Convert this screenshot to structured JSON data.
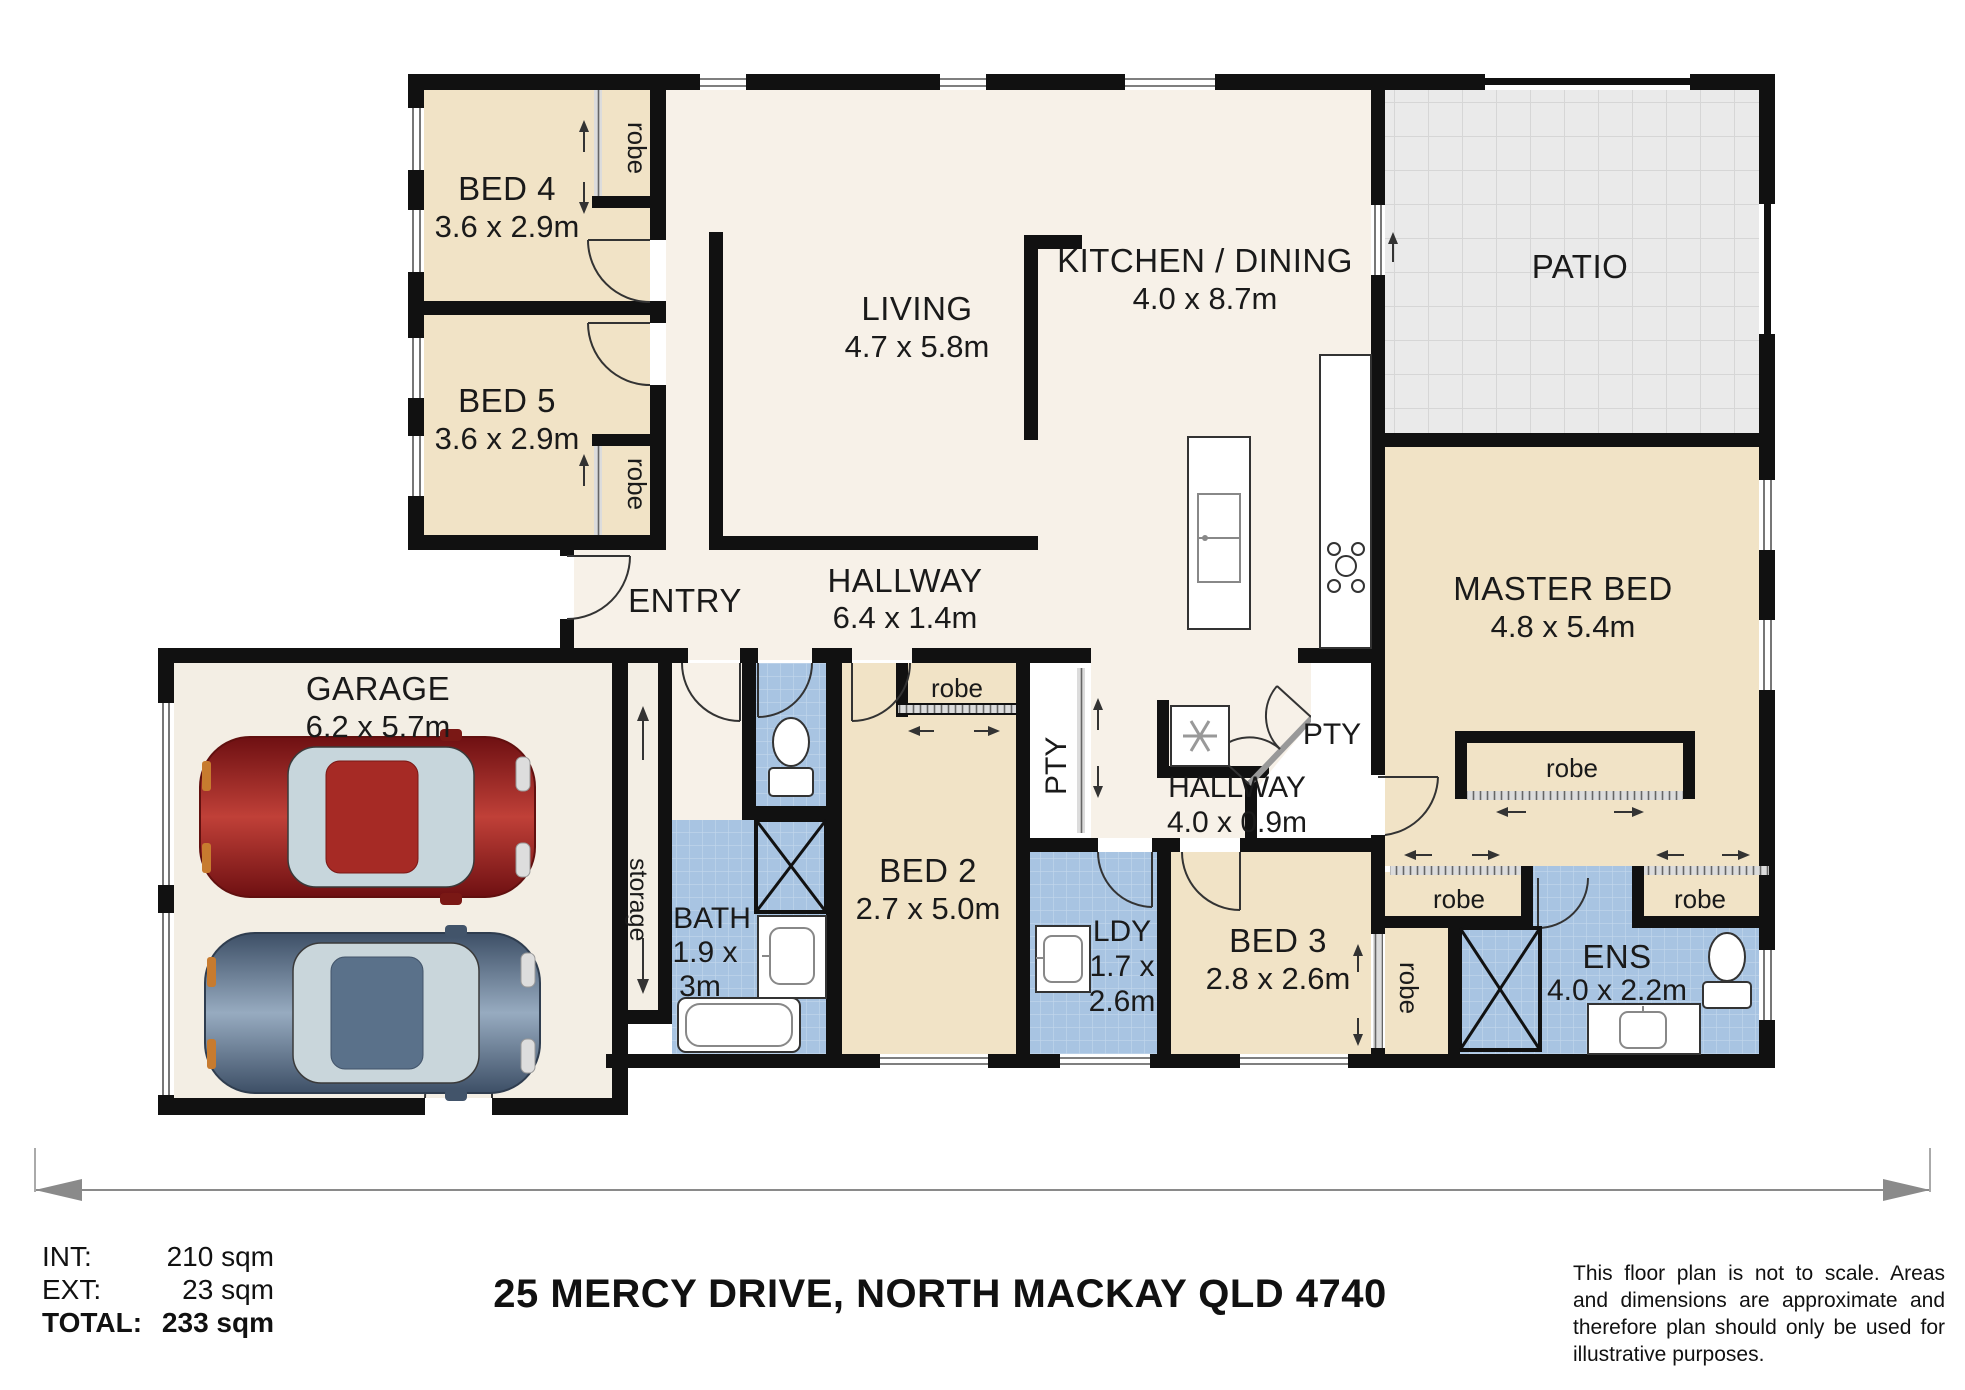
{
  "title": "25 MERCY DRIVE, NORTH MACKAY QLD 4740",
  "areas": {
    "int_label": "INT:",
    "int_value": "210 sqm",
    "ext_label": "EXT:",
    "ext_value": "23 sqm",
    "total_label": "TOTAL:",
    "total_value": "233 sqm"
  },
  "disclaimer": "This floor plan is not to scale. Areas and dimensions are approximate and therefore plan should only be used for illustrative purposes.",
  "rooms": {
    "bed4": {
      "name": "BED 4",
      "dims": "3.6 x 2.9m"
    },
    "bed5": {
      "name": "BED 5",
      "dims": "3.6 x 2.9m"
    },
    "living": {
      "name": "LIVING",
      "dims": "4.7 x 5.8m"
    },
    "kitchen_dining": {
      "name": "KITCHEN / DINING",
      "dims": "4.0 x 8.7m"
    },
    "patio": {
      "name": "PATIO"
    },
    "master_bed": {
      "name": "MASTER BED",
      "dims": "4.8 x 5.4m"
    },
    "entry": {
      "name": "ENTRY"
    },
    "hallway_main": {
      "name": "HALLWAY",
      "dims": "6.4 x 1.4m"
    },
    "hallway_rear": {
      "name": "HALLWAY",
      "dims": "4.0 x 0.9m"
    },
    "garage": {
      "name": "GARAGE",
      "dims": "6.2 x 5.7m"
    },
    "bed2": {
      "name": "BED 2",
      "dims": "2.7 x 5.0m"
    },
    "bed3": {
      "name": "BED 3",
      "dims": "2.8 x 2.6m"
    },
    "bath": {
      "name": "BATH",
      "dims1": "1.9 x",
      "dims2": "3m"
    },
    "laundry": {
      "name": "LDY",
      "dims1": "1.7 x",
      "dims2": "2.6m"
    },
    "ensuite": {
      "name": "ENS",
      "dims": "4.0 x 2.2m"
    },
    "storage": {
      "name": "storage"
    }
  },
  "labels": {
    "robe": "robe",
    "pantry": "PTY"
  },
  "icons": {
    "fridge": "snowflake",
    "cooktop": "burner-rings",
    "shower": "x-cross",
    "toilet": "toilet",
    "sink": "basin",
    "bathtub": "tub",
    "laundry_tub": "square-tub",
    "cars": "car-top-view"
  },
  "colors": {
    "wall": "#111111",
    "bedroom": "#f1e3c6",
    "living": "#f7f1e8",
    "wet": "#a8c4e2",
    "patio": "#eaeaea",
    "car_red": "#c04038",
    "car_blue": "#97abc0"
  }
}
